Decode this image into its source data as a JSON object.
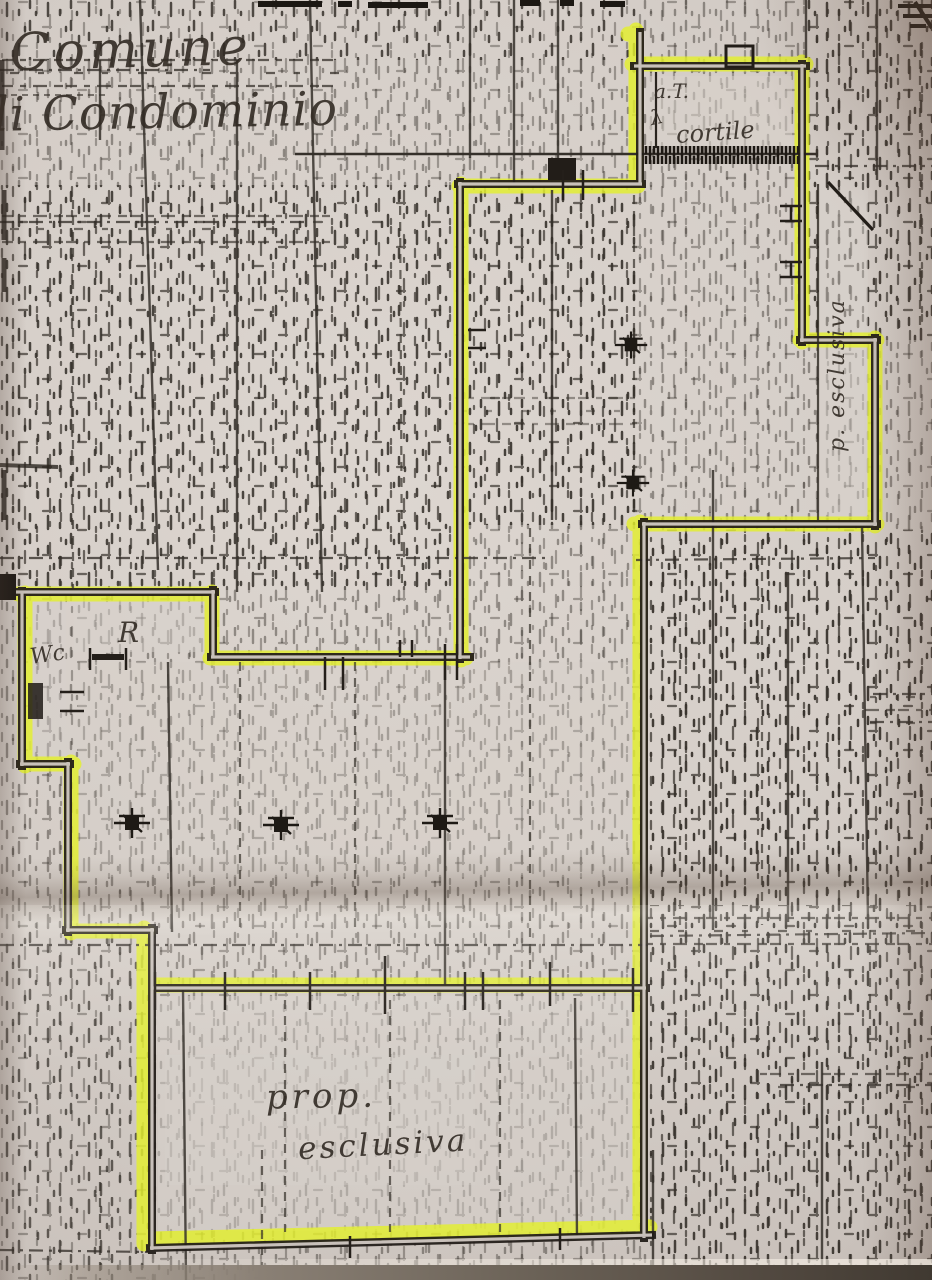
{
  "plan": {
    "labels": {
      "municipality": "Comune",
      "condominium": "li Condominio",
      "courtyard_abbrev": "a.T.",
      "courtyard_mark": "λ",
      "courtyard": "cortile",
      "wc": "Wc",
      "room_r": "R",
      "strip_vertical": "p. esclusiva",
      "property_line1": "prop.",
      "property_line2": "esclusiva"
    },
    "colors": {
      "paper": "#d7cfc9",
      "ink": "#29241f",
      "highlighter": "#e3ef2d"
    }
  }
}
